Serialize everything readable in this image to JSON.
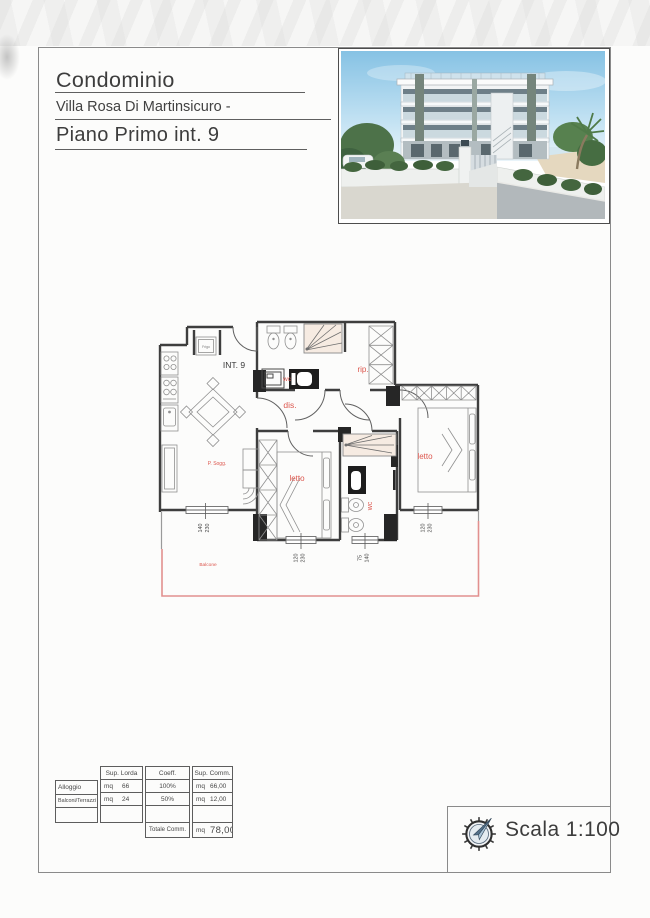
{
  "document": {
    "title_block": {
      "building_type": "Condominio",
      "building_name": "Villa Rosa Di Martinsicuro -",
      "floor_unit": "Piano Primo int. 9"
    },
    "photo": {
      "name": "condominio-rendering"
    },
    "scale_box": {
      "scale_label": "Scala 1:100",
      "compass_icon": "compass-rose-icon"
    }
  },
  "floor_plan": {
    "unit_label": "INT. 9",
    "labels": {
      "fridge": "Frigo",
      "living": "P. Sogg.",
      "hall": "dis.",
      "storage": "rip.",
      "bath_top": "wc",
      "bedroom_mid": "letto",
      "bath_bottom": "wc",
      "bedroom_right": "letto",
      "balcony": "Balcone"
    },
    "window_dimensions": {
      "living": {
        "width": "140",
        "height": "230"
      },
      "bedroom_mid": {
        "width": "120",
        "height": "230"
      },
      "bath_bottom": {
        "width": "75",
        "height": "140"
      },
      "bedroom_right": {
        "width": "120",
        "height": "230"
      }
    },
    "colors": {
      "wall": "#3e3e3e",
      "label_red": "#dc574e",
      "balcony_pink": "#e2908f"
    }
  },
  "area_table": {
    "col_headers": [
      "Sup. Lorda",
      "Coeff.",
      "Sup. Comm."
    ],
    "rows": [
      {
        "label": "Alloggio",
        "mq1": "mq",
        "lorda": "66",
        "coeff": "100%",
        "mq2": "mq",
        "comm": "66,00"
      },
      {
        "label": "Balconi/Terrazzi",
        "mq1": "mq",
        "lorda": "24",
        "coeff": "50%",
        "mq2": "mq",
        "comm": "12,00"
      }
    ],
    "total_row": {
      "label": "Totale Comm.",
      "mq": "mq",
      "value": "78,00"
    }
  }
}
